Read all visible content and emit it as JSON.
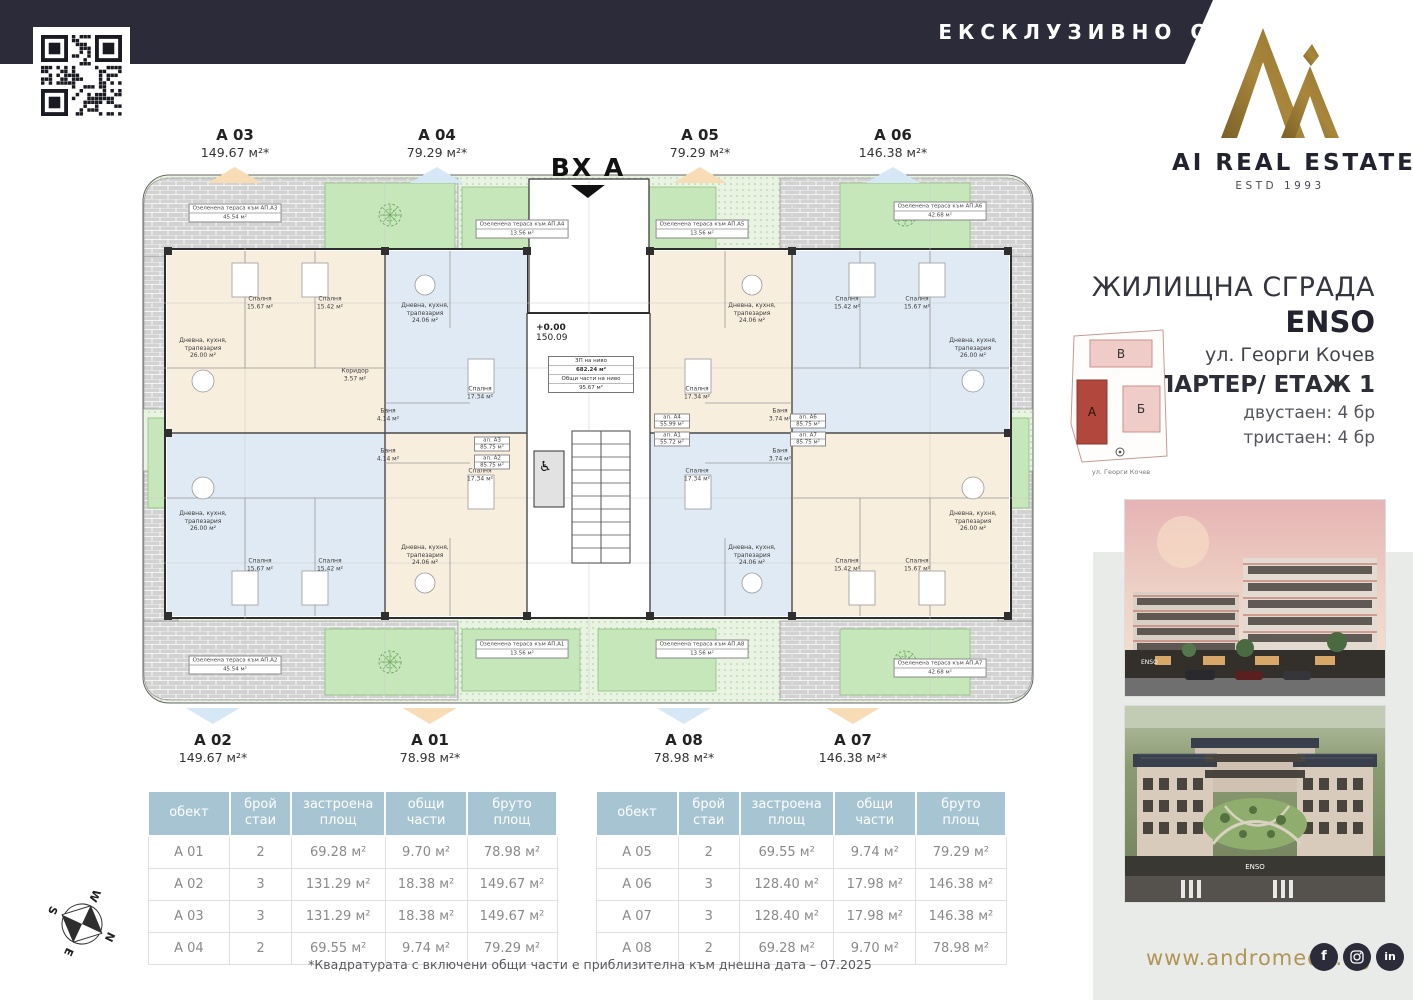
{
  "banner": {
    "text": "ЕКСКЛУЗИВНО ОТ"
  },
  "logo": {
    "name": "AI REAL ESTATE",
    "estd": "ESTD 1993"
  },
  "project": {
    "type_label": "ЖИЛИЩНА СГРАДА",
    "name": "ENSO",
    "street": "ул. Георги Кочев",
    "floor_label": "ПАРТЕР/ ЕТАЖ 1",
    "mix_line1": "двустаен: 4 бр",
    "mix_line2": "тристаен: 4 бр"
  },
  "site_map": {
    "block_v": "В",
    "block_a": "А",
    "block_b": "Б",
    "street": "ул. Георги Кочев"
  },
  "plan": {
    "entrance_label": "ВХ А",
    "elevation": "+0.00",
    "level": "150.09",
    "wheelchair_icon": "♿",
    "core_box": [
      "ЗП на ниво",
      "682.24 м²",
      "Общи части на ниво",
      "95.67 м²"
    ],
    "unit_markers": [
      {
        "name": "A 03",
        "area": "149.67 м²*",
        "side": "top",
        "x": 235,
        "color": "peach"
      },
      {
        "name": "A 04",
        "area": "79.29 м²*",
        "side": "top",
        "x": 437,
        "color": "blue"
      },
      {
        "name": "A 05",
        "area": "79.29 м²*",
        "side": "top",
        "x": 700,
        "color": "peach"
      },
      {
        "name": "A 06",
        "area": "146.38 м²*",
        "side": "top",
        "x": 893,
        "color": "blue"
      },
      {
        "name": "A 02",
        "area": "149.67 м²*",
        "side": "bottom",
        "x": 213,
        "color": "blue"
      },
      {
        "name": "A 01",
        "area": "78.98 м²*",
        "side": "bottom",
        "x": 430,
        "color": "peach"
      },
      {
        "name": "A 08",
        "area": "78.98 м²*",
        "side": "bottom",
        "x": 684,
        "color": "blue"
      },
      {
        "name": "A 07",
        "area": "146.38 м²*",
        "side": "bottom",
        "x": 853,
        "color": "peach"
      }
    ],
    "room_labels": [
      {
        "x": 63,
        "y": 185,
        "t": "Дневна, кухня,\nтрапезария\n26.00 м²"
      },
      {
        "x": 120,
        "y": 140,
        "t": "Спалня\n15.67 м²"
      },
      {
        "x": 190,
        "y": 140,
        "t": "Спалня\n15.42 м²"
      },
      {
        "x": 215,
        "y": 212,
        "t": "Коридор\n3.57 м²"
      },
      {
        "x": 285,
        "y": 150,
        "t": "Дневна, кухня,\nтрапезария\n24.06 м²"
      },
      {
        "x": 340,
        "y": 230,
        "t": "Спалня\n17.34 м²"
      },
      {
        "x": 612,
        "y": 150,
        "t": "Дневна, кухня,\nтрапезария\n24.06 м²"
      },
      {
        "x": 557,
        "y": 230,
        "t": "Спалня\n17.34 м²"
      },
      {
        "x": 833,
        "y": 185,
        "t": "Дневна, кухня,\nтрапезария\n26.00 м²"
      },
      {
        "x": 707,
        "y": 140,
        "t": "Спалня\n15.42 м²"
      },
      {
        "x": 777,
        "y": 140,
        "t": "Спалня\n15.67 м²"
      },
      {
        "x": 63,
        "y": 358,
        "t": "Дневна, кухня,\nтрапезария\n26.00 м²"
      },
      {
        "x": 120,
        "y": 402,
        "t": "Спалня\n15.67 м²"
      },
      {
        "x": 190,
        "y": 402,
        "t": "Спалня\n15.42 м²"
      },
      {
        "x": 285,
        "y": 392,
        "t": "Дневна, кухня,\nтрапезария\n24.06 м²"
      },
      {
        "x": 340,
        "y": 312,
        "t": "Спалня\n17.34 м²"
      },
      {
        "x": 612,
        "y": 392,
        "t": "Дневна, кухня,\nтрапезария\n24.06 м²"
      },
      {
        "x": 557,
        "y": 312,
        "t": "Спалня\n17.34 м²"
      },
      {
        "x": 833,
        "y": 358,
        "t": "Дневна, кухня,\nтрапезария\n26.00 м²"
      },
      {
        "x": 707,
        "y": 402,
        "t": "Спалня\n15.42 м²"
      },
      {
        "x": 777,
        "y": 402,
        "t": "Спалня\n15.67 м²"
      },
      {
        "x": 248,
        "y": 252,
        "t": "Баня\n4.14 м²"
      },
      {
        "x": 248,
        "y": 292,
        "t": "Баня\n4.14 м²"
      },
      {
        "x": 640,
        "y": 252,
        "t": "Баня\n3.74 м²"
      },
      {
        "x": 640,
        "y": 292,
        "t": "Баня\n3.74 м²"
      }
    ],
    "terrace_labels": [
      {
        "x": 95,
        "y": 50,
        "l1": "Озеленена тераса към АП.А3",
        "l2": "45.54 м²"
      },
      {
        "x": 382,
        "y": 66,
        "l1": "Озеленена тераса към АП.А4",
        "l2": "13.56 м²"
      },
      {
        "x": 562,
        "y": 66,
        "l1": "Озеленена тераса към АП.А5",
        "l2": "13.56 м²"
      },
      {
        "x": 800,
        "y": 48,
        "l1": "Озеленена тераса към АП.А6",
        "l2": "42.68 м²"
      },
      {
        "x": 95,
        "y": 502,
        "l1": "Озеленена тераса към АП.А2",
        "l2": "45.54 м²"
      },
      {
        "x": 382,
        "y": 486,
        "l1": "Озеленена тераса към АП.А1",
        "l2": "13.56 м²"
      },
      {
        "x": 562,
        "y": 486,
        "l1": "Озеленена тераса към АП.А8",
        "l2": "13.56 м²"
      },
      {
        "x": 800,
        "y": 505,
        "l1": "Озеленена тераса към АП.А7",
        "l2": "42.68 м²"
      }
    ],
    "unit_tags": [
      {
        "x": 352,
        "y": 281,
        "l1": "ап. А3",
        "l2": "85.75 м²"
      },
      {
        "x": 352,
        "y": 299,
        "l1": "ап. А2",
        "l2": "85.75 м²"
      },
      {
        "x": 532,
        "y": 258,
        "l1": "ап. А4",
        "l2": "55.99 м²"
      },
      {
        "x": 532,
        "y": 276,
        "l1": "ап. А1",
        "l2": "55.72 м²"
      },
      {
        "x": 668,
        "y": 258,
        "l1": "ап. А6",
        "l2": "85.75 м²"
      },
      {
        "x": 668,
        "y": 276,
        "l1": "ап. А7",
        "l2": "85.75 м²"
      }
    ]
  },
  "tables": [
    {
      "headers": [
        "обект",
        "брой\nстаи",
        "застроена\nплощ",
        "общи части",
        "бруто\nплощ"
      ],
      "rows": [
        [
          "A 01",
          "2",
          "69.28 м²",
          "9.70 м²",
          "78.98 м²"
        ],
        [
          "A 02",
          "3",
          "131.29 м²",
          "18.38 м²",
          "149.67 м²"
        ],
        [
          "A 03",
          "3",
          "131.29 м²",
          "18.38 м²",
          "149.67 м²"
        ],
        [
          "A 04",
          "2",
          "69.55 м²",
          "9.74 м²",
          "79.29 м²"
        ]
      ]
    },
    {
      "headers": [
        "обект",
        "брой\nстаи",
        "застроена\nплощ",
        "общи части",
        "бруто\nплощ"
      ],
      "rows": [
        [
          "A 05",
          "2",
          "69.55 м²",
          "9.74 м²",
          "79.29 м²"
        ],
        [
          "A 06",
          "3",
          "128.40 м²",
          "17.98 м²",
          "146.38 м²"
        ],
        [
          "A 07",
          "3",
          "128.40 м²",
          "17.98 м²",
          "146.38 м²"
        ],
        [
          "A 08",
          "2",
          "69.28 м²",
          "9.70 м²",
          "78.98 м²"
        ]
      ]
    }
  ],
  "footnote": "*Квадратурата с включени общи части е приблизителна към днешна дата – 07.2025",
  "footer": {
    "website": "www.andromeda.bg",
    "social": [
      "facebook",
      "instagram",
      "linkedin"
    ]
  },
  "photos": {
    "sign1": "ENSO",
    "sign2": "ENSO"
  },
  "compass": {
    "n": "N",
    "e": "E",
    "s": "S",
    "w": "W"
  },
  "colors": {
    "navy": "#2b2b39",
    "gold": "#9c7c35",
    "gold_text": "#b29555",
    "unit_cream": "#f8eedd",
    "unit_blue": "#dfeaf4",
    "green": "#c6e7ba",
    "table_header": "#a7c4d3",
    "marker_peach": "#f8dcb6",
    "marker_blue": "#d6e7f6",
    "site_block_dark": "#b2473e",
    "site_block_light": "#f0ccc8"
  }
}
